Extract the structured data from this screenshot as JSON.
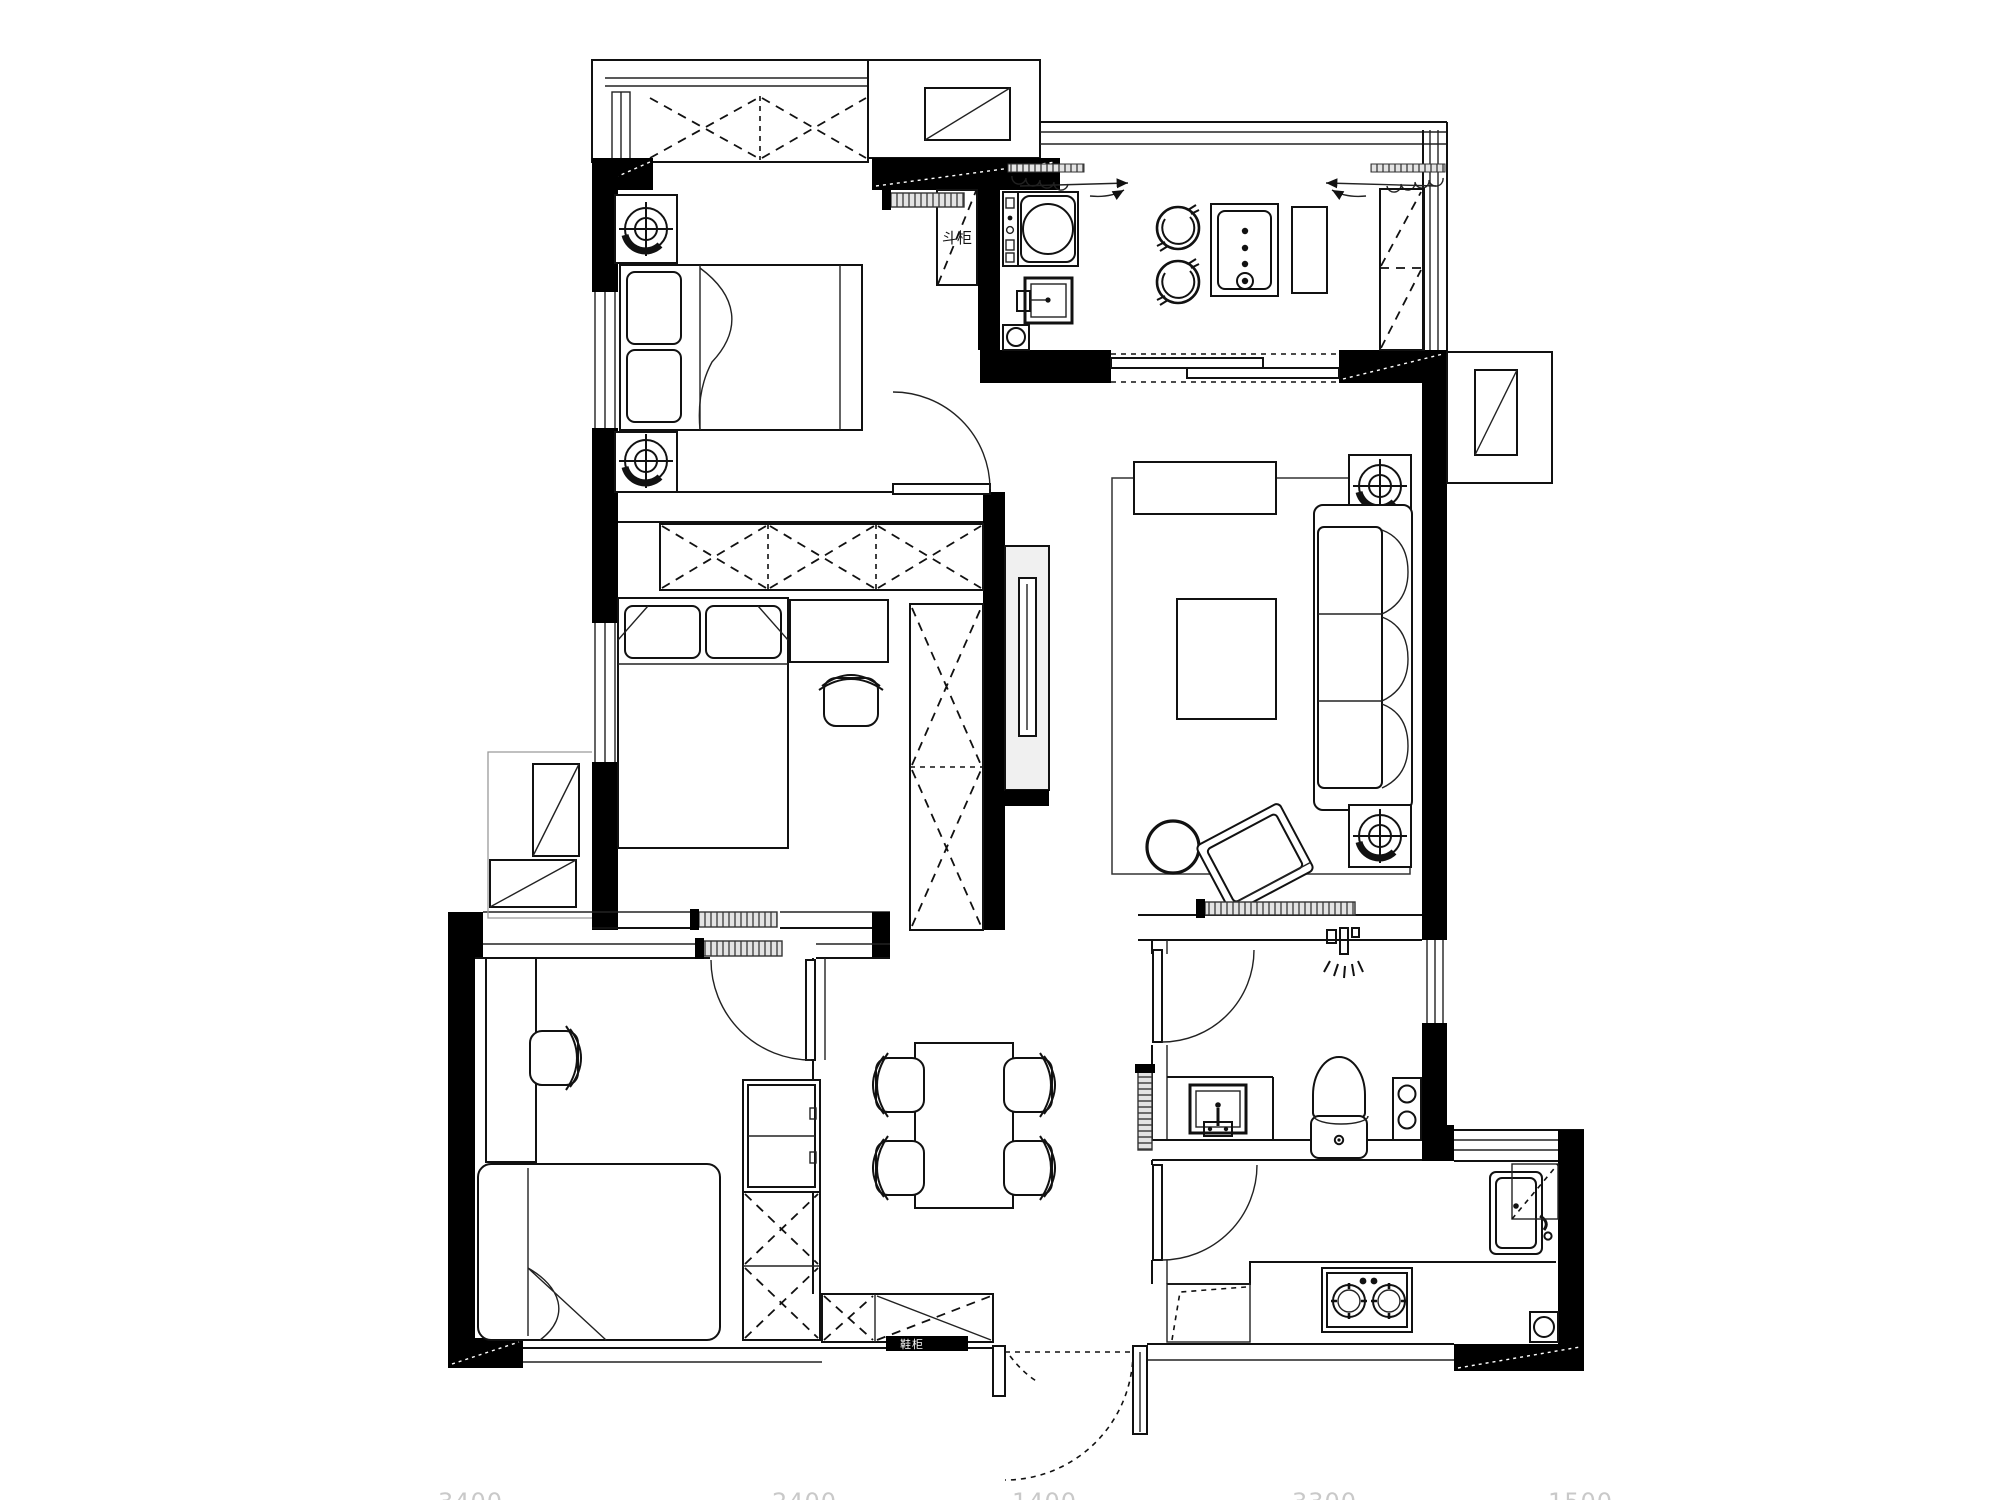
{
  "drawing": {
    "type": "residential floor plan, black-and-white line drawing",
    "background": "#ffffff"
  },
  "colors": {
    "line": "#111111",
    "wall_fill": "#000000",
    "panel_gray": "#f0f0f0",
    "hatch_stroke": "#444444",
    "faint_dim_text": "#c9c9c9"
  },
  "labels": {
    "dresser": "斗柜",
    "shoe_cabinet": "鞋柜"
  },
  "dimensions_bottom": [
    "3400",
    "2400",
    "1400",
    "3300",
    "1500"
  ],
  "icons": [
    "double-bed",
    "single-bed",
    "pillow",
    "nightstand-lamp",
    "wardrobe-cross",
    "door-swing",
    "sliding-door-panel",
    "curtain-coil",
    "window-triple-line",
    "washing-machine",
    "laundry-sink",
    "floor-drain",
    "water-heater",
    "stool-pot",
    "tall-cabinet",
    "range-flue",
    "ac-outdoor-unit",
    "tv-panel",
    "tv-console",
    "sofa-three-seat",
    "coffee-table",
    "rug",
    "round-stool",
    "armchair",
    "side-table-lamp",
    "dining-table",
    "dining-chair",
    "desk",
    "desk-chair",
    "bookshelf",
    "shoe-cabinet",
    "toilet",
    "vanity-basin",
    "shower-mixer",
    "towel-shelf",
    "gas-hob",
    "kitchen-sink",
    "entry-door-dashed",
    "dresser-box"
  ]
}
